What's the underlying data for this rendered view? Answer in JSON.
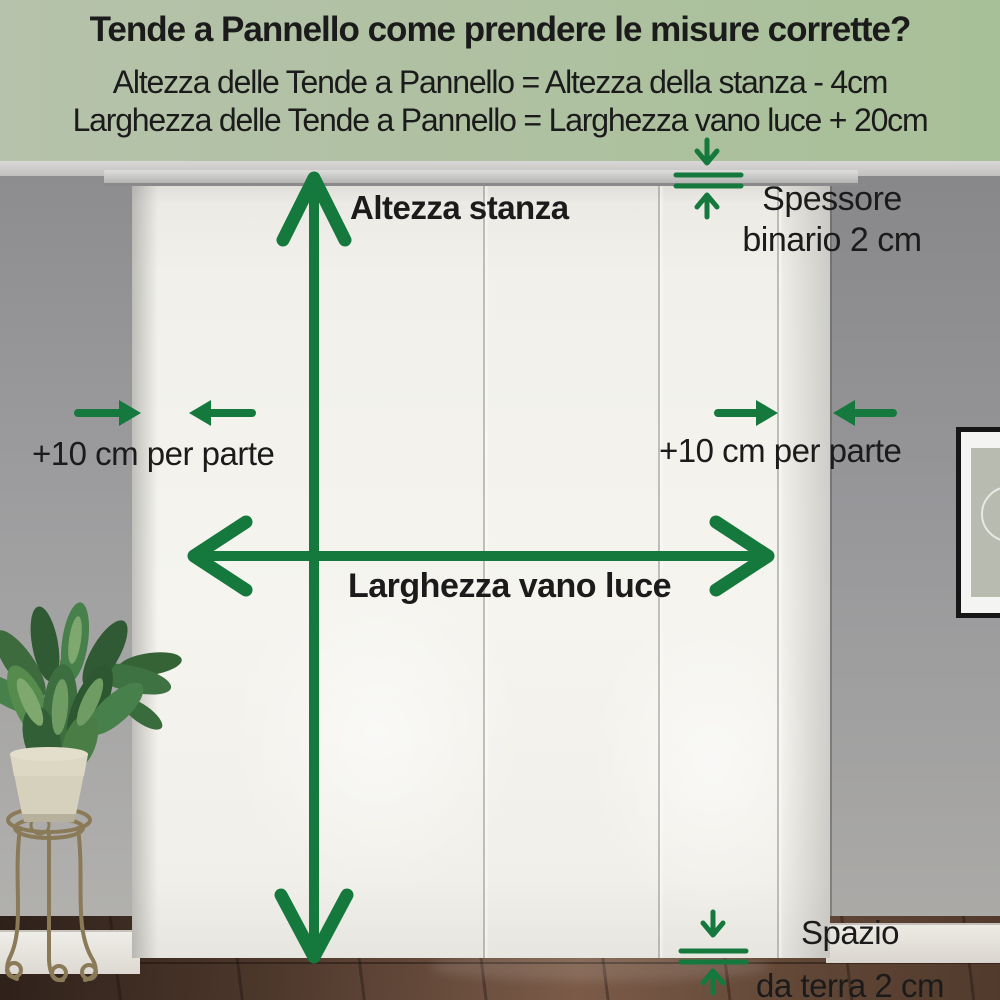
{
  "header": {
    "title": "Tende a Pannello come prendere le misure corrette?",
    "formula_height": "Altezza delle Tende a Pannello = Altezza della stanza - 4cm",
    "formula_width": "Larghezza delle Tende a Pannello = Larghezza vano luce + 20cm"
  },
  "annotations": {
    "room_height": "Altezza stanza",
    "rail_thickness_line1": "Spessore",
    "rail_thickness_line2": "binario 2 cm",
    "allowance_left": "+10 cm per parte",
    "allowance_right": "+10 cm per parte",
    "opening_width": "Larghezza vano luce",
    "floor_gap_line1": "Spazio",
    "floor_gap_line2": "da terra 2 cm"
  },
  "colors": {
    "arrow_green": "#15793d",
    "header_left": "#b6c2ab",
    "header_right": "#a8c098",
    "text": "#1b1b1b"
  }
}
